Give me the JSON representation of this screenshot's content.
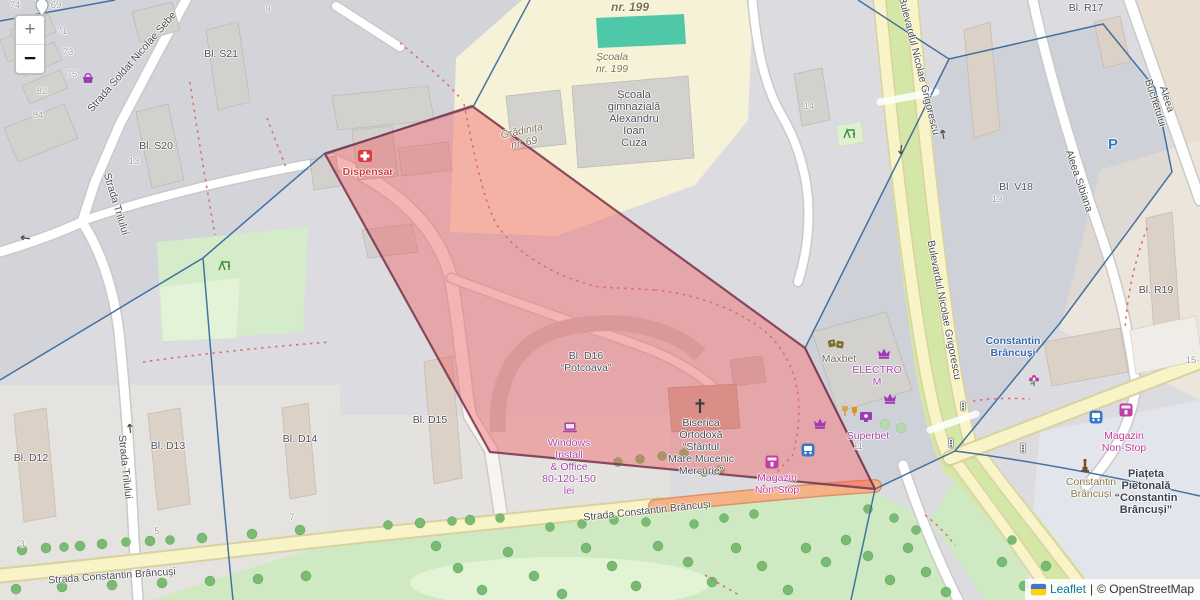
{
  "controls": {
    "zoom_in_label": "+",
    "zoom_out_label": "−"
  },
  "attribution": {
    "flag_name": "ukraine-flag",
    "leaflet_link": "Leaflet",
    "separator": "|",
    "copyright": "© OpenStreetMap"
  },
  "overlay": {
    "name": "highlighted-area",
    "fill": "#f05a5f",
    "border": "#7e3a50"
  },
  "colors": {
    "boundary": "#33669b",
    "road_yellow": "#f8f4c8",
    "road_orange": "#f5b285",
    "park_green": "#cfeac2",
    "pitch_teal": "#4fc8a9",
    "school_yellow": "#f6f2d8"
  },
  "map_labels": [
    {
      "n": "street-soldat-nicolae-sebe",
      "t": "Strada Soldat Nicolae Sebe",
      "x": 132,
      "y": 62,
      "r": -49,
      "c": "street"
    },
    {
      "n": "street-trilului-north",
      "t": "Strada Trilului",
      "x": 116,
      "y": 204,
      "r": 73,
      "c": "street"
    },
    {
      "n": "street-trilului-south",
      "t": "Strada Trilului",
      "x": 125,
      "y": 467,
      "r": 84,
      "c": "street"
    },
    {
      "n": "street-constantin-brancusi-west",
      "t": "Strada Constantin Brâncuși",
      "x": 112,
      "y": 576,
      "r": -4,
      "c": "street"
    },
    {
      "n": "street-constantin-brancusi-mid",
      "t": "Strada Constantin Brâncuși",
      "x": 647,
      "y": 511,
      "r": -6,
      "c": "street"
    },
    {
      "n": "street-bulevardul-grigorescu-north",
      "t": "Bulevardul Nicolae Grigorescu",
      "x": 919,
      "y": 66,
      "r": 76,
      "c": "street"
    },
    {
      "n": "street-bulevardul-grigorescu-south",
      "t": "Bulevardul Nicolae Grigorescu",
      "x": 944,
      "y": 310,
      "r": 79,
      "c": "street"
    },
    {
      "n": "street-aleea-buchetului",
      "t": "Aleea Buchetului",
      "x": 1161,
      "y": 101,
      "r": 72,
      "c": "street"
    },
    {
      "n": "street-aleea-sibiana",
      "t": "Aleea Sibiana",
      "x": 1079,
      "y": 181,
      "r": 71,
      "c": "street"
    },
    {
      "n": "area-nr-199",
      "t": "nr. 199",
      "x": 630,
      "y": 7,
      "r": 0,
      "c": "area area-lg"
    },
    {
      "n": "area-scoala-nr-199",
      "t": "Școala\nnr. 199",
      "x": 612,
      "y": 63,
      "r": 0,
      "c": "area"
    },
    {
      "n": "area-gradinita-nr-69",
      "t": "Grădinița\nnr. 69",
      "x": 523,
      "y": 137,
      "r": -12,
      "c": "area"
    },
    {
      "n": "label-scoala-gimnaziala",
      "t": "Școala\ngimnazială\nAlexandru\nIoan\nCuza",
      "x": 634,
      "y": 119,
      "r": 0,
      "c": "school"
    },
    {
      "n": "label-bl-s21",
      "t": "Bl. S21",
      "x": 221,
      "y": 54,
      "r": 0,
      "c": "bldg"
    },
    {
      "n": "label-bl-s20",
      "t": "Bl. S20",
      "x": 156,
      "y": 146,
      "r": 0,
      "c": "bldg"
    },
    {
      "n": "label-bl-d16-potcoava",
      "t": "Bl. D16\n“Potcoava”",
      "x": 586,
      "y": 362,
      "r": 0,
      "c": "bldg"
    },
    {
      "n": "label-bl-d15",
      "t": "Bl. D15",
      "x": 430,
      "y": 420,
      "r": 0,
      "c": "bldg"
    },
    {
      "n": "label-bl-d14",
      "t": "Bl. D14",
      "x": 300,
      "y": 439,
      "r": 0,
      "c": "bldg"
    },
    {
      "n": "label-bl-d13",
      "t": "Bl. D13",
      "x": 168,
      "y": 446,
      "r": 0,
      "c": "bldg"
    },
    {
      "n": "label-bl-d12",
      "t": "Bl. D12",
      "x": 31,
      "y": 458,
      "r": 0,
      "c": "bldg"
    },
    {
      "n": "label-bl-v18",
      "t": "Bl. V18",
      "x": 1016,
      "y": 187,
      "r": 0,
      "c": "bldg"
    },
    {
      "n": "label-bl-r17",
      "t": "Bl. R17",
      "x": 1086,
      "y": 8,
      "r": 0,
      "c": "bldg"
    },
    {
      "n": "label-bl-r19",
      "t": "Bl. R19",
      "x": 1156,
      "y": 290,
      "r": 0,
      "c": "bldg"
    },
    {
      "n": "housenumber-74",
      "t": "74",
      "x": 15,
      "y": 6,
      "r": 0,
      "c": "num"
    },
    {
      "n": "housenumber-69",
      "t": "69",
      "x": 56,
      "y": 6,
      "r": 0,
      "c": "num"
    },
    {
      "n": "housenumber-9",
      "t": "9",
      "x": 268,
      "y": 10,
      "r": 0,
      "c": "num"
    },
    {
      "n": "housenumber-71",
      "t": "71",
      "x": 62,
      "y": 32,
      "r": 0,
      "c": "num"
    },
    {
      "n": "housenumber-73",
      "t": "73",
      "x": 68,
      "y": 53,
      "r": 0,
      "c": "num"
    },
    {
      "n": "housenumber-75",
      "t": "75",
      "x": 72,
      "y": 75,
      "r": 0,
      "c": "num"
    },
    {
      "n": "housenumber-82",
      "t": "82",
      "x": 42,
      "y": 92,
      "r": 0,
      "c": "num"
    },
    {
      "n": "housenumber-84",
      "t": "84",
      "x": 38,
      "y": 116,
      "r": 0,
      "c": "num"
    },
    {
      "n": "housenumber-13",
      "t": "13",
      "x": 134,
      "y": 162,
      "r": 0,
      "c": "num"
    },
    {
      "n": "housenumber-14",
      "t": "14",
      "x": 809,
      "y": 107,
      "r": 0,
      "c": "num"
    },
    {
      "n": "housenumber-19",
      "t": "19",
      "x": 997,
      "y": 200,
      "r": 0,
      "c": "num"
    },
    {
      "n": "housenumber-3",
      "t": "3",
      "x": 22,
      "y": 545,
      "r": 0,
      "c": "num"
    },
    {
      "n": "housenumber-5",
      "t": "5",
      "x": 157,
      "y": 532,
      "r": 0,
      "c": "num"
    },
    {
      "n": "housenumber-7",
      "t": "7",
      "x": 292,
      "y": 518,
      "r": 0,
      "c": "num"
    },
    {
      "n": "housenumber-15",
      "t": "15",
      "x": 1191,
      "y": 361,
      "r": 0,
      "c": "num"
    },
    {
      "n": "housenumber-11",
      "t": "11",
      "x": 858,
      "y": 447,
      "r": 0,
      "c": "num"
    },
    {
      "n": "poi-dispensar",
      "t": "Dispensar",
      "x": 368,
      "y": 172,
      "r": 0,
      "c": "p-red"
    },
    {
      "n": "poi-maxbet",
      "t": "Maxbet",
      "x": 839,
      "y": 359,
      "r": 0,
      "c": "p-olive"
    },
    {
      "n": "poi-electro-m",
      "t": "ELECTRO\nM",
      "x": 877,
      "y": 376,
      "r": 0,
      "c": "p-purple"
    },
    {
      "n": "poi-superbet",
      "t": "Superbet",
      "x": 868,
      "y": 436,
      "r": 0,
      "c": "p-purple"
    },
    {
      "n": "poi-windows-install",
      "t": "Windows\nInstall\n& Office\n80-120-150\nlei",
      "x": 569,
      "y": 467,
      "r": 0,
      "c": "p-purple"
    },
    {
      "n": "poi-magazin-non-stop-church",
      "t": "Magazin\nNon-Stop",
      "x": 777,
      "y": 484,
      "r": 0,
      "c": "p-magenta"
    },
    {
      "n": "poi-magazin-non-stop-east",
      "t": "Magazin\nNon-Stop",
      "x": 1124,
      "y": 442,
      "r": 0,
      "c": "p-magenta"
    },
    {
      "n": "poi-biserica-ortodoxa",
      "t": "Biserica\nOrtodoxă\n“Sfântul\nMare Mucenic\nMercurie”",
      "x": 701,
      "y": 447,
      "r": 0,
      "c": "p-dark"
    },
    {
      "n": "poi-metro-constantin-brancusi",
      "t": "Constantin\nBrâncuși",
      "x": 1013,
      "y": 347,
      "r": 0,
      "c": "p-blue"
    },
    {
      "n": "poi-statue-constantin-brancusi",
      "t": "Constantin\nBrâncuși",
      "x": 1091,
      "y": 488,
      "r": 0,
      "c": "p-gold"
    },
    {
      "n": "poi-piateta-pietonala",
      "t": "Piațeta\nPietonală\n“Constantin\nBrâncuși”",
      "x": 1146,
      "y": 492,
      "r": 0,
      "c": "p-darkbold"
    },
    {
      "n": "parking-symbol",
      "t": "P",
      "x": 1113,
      "y": 145,
      "r": 0,
      "c": "parking"
    }
  ],
  "icons": [
    {
      "n": "map-pin-icon",
      "t": "pin",
      "x": 42,
      "y": 8,
      "r": 0
    },
    {
      "n": "boutique-icon",
      "t": "basket",
      "x": 88,
      "y": 78,
      "r": 0
    },
    {
      "n": "hospital-icon",
      "t": "medkit",
      "x": 365,
      "y": 156,
      "r": 0
    },
    {
      "n": "playground-icon",
      "t": "playground",
      "x": 224,
      "y": 266,
      "r": 0
    },
    {
      "n": "playground-icon",
      "t": "playground",
      "x": 849,
      "y": 134,
      "r": 0
    },
    {
      "n": "dice-icon",
      "t": "dice",
      "x": 836,
      "y": 344,
      "r": 0
    },
    {
      "n": "crown-icon",
      "t": "crown",
      "x": 884,
      "y": 353,
      "r": 0
    },
    {
      "n": "crown-icon",
      "t": "crown",
      "x": 890,
      "y": 398,
      "r": 0
    },
    {
      "n": "crown-icon",
      "t": "crown",
      "x": 820,
      "y": 423,
      "r": 0
    },
    {
      "n": "restaurant-icon",
      "t": "food",
      "x": 850,
      "y": 411,
      "r": 0
    },
    {
      "n": "arcade-icon",
      "t": "arcade",
      "x": 866,
      "y": 417,
      "r": 0
    },
    {
      "n": "bus-stop-icon",
      "t": "bus",
      "x": 808,
      "y": 450,
      "r": 0
    },
    {
      "n": "bus-stop-icon",
      "t": "bus",
      "x": 1096,
      "y": 417,
      "r": 0
    },
    {
      "n": "shop-icon",
      "t": "shop",
      "x": 772,
      "y": 462,
      "r": 0
    },
    {
      "n": "shop-icon",
      "t": "shop",
      "x": 1126,
      "y": 410,
      "r": 0
    },
    {
      "n": "florist-icon",
      "t": "flower",
      "x": 1034,
      "y": 380,
      "r": 0
    },
    {
      "n": "statue-icon",
      "t": "statue",
      "x": 1085,
      "y": 466,
      "r": 0
    },
    {
      "n": "church-cross-icon",
      "t": "cross",
      "x": 700,
      "y": 406,
      "r": 0
    },
    {
      "n": "laptop-icon",
      "t": "laptop",
      "x": 570,
      "y": 427,
      "r": 0
    },
    {
      "n": "traffic-light-icon",
      "t": "traffic",
      "x": 963,
      "y": 406,
      "r": 0
    },
    {
      "n": "traffic-light-icon",
      "t": "traffic",
      "x": 951,
      "y": 443,
      "r": 0
    },
    {
      "n": "traffic-light-icon",
      "t": "traffic",
      "x": 1023,
      "y": 448,
      "r": 0
    },
    {
      "n": "oneway-arrow-icon",
      "t": "arrow",
      "x": 25,
      "y": 238,
      "r": 190
    },
    {
      "n": "oneway-arrow-icon",
      "t": "arrow",
      "x": 130,
      "y": 428,
      "r": -97
    },
    {
      "n": "oneway-arrow-icon",
      "t": "arrow",
      "x": 943,
      "y": 134,
      "r": -100
    },
    {
      "n": "oneway-arrow-icon",
      "t": "arrow",
      "x": 901,
      "y": 150,
      "r": 96
    }
  ]
}
